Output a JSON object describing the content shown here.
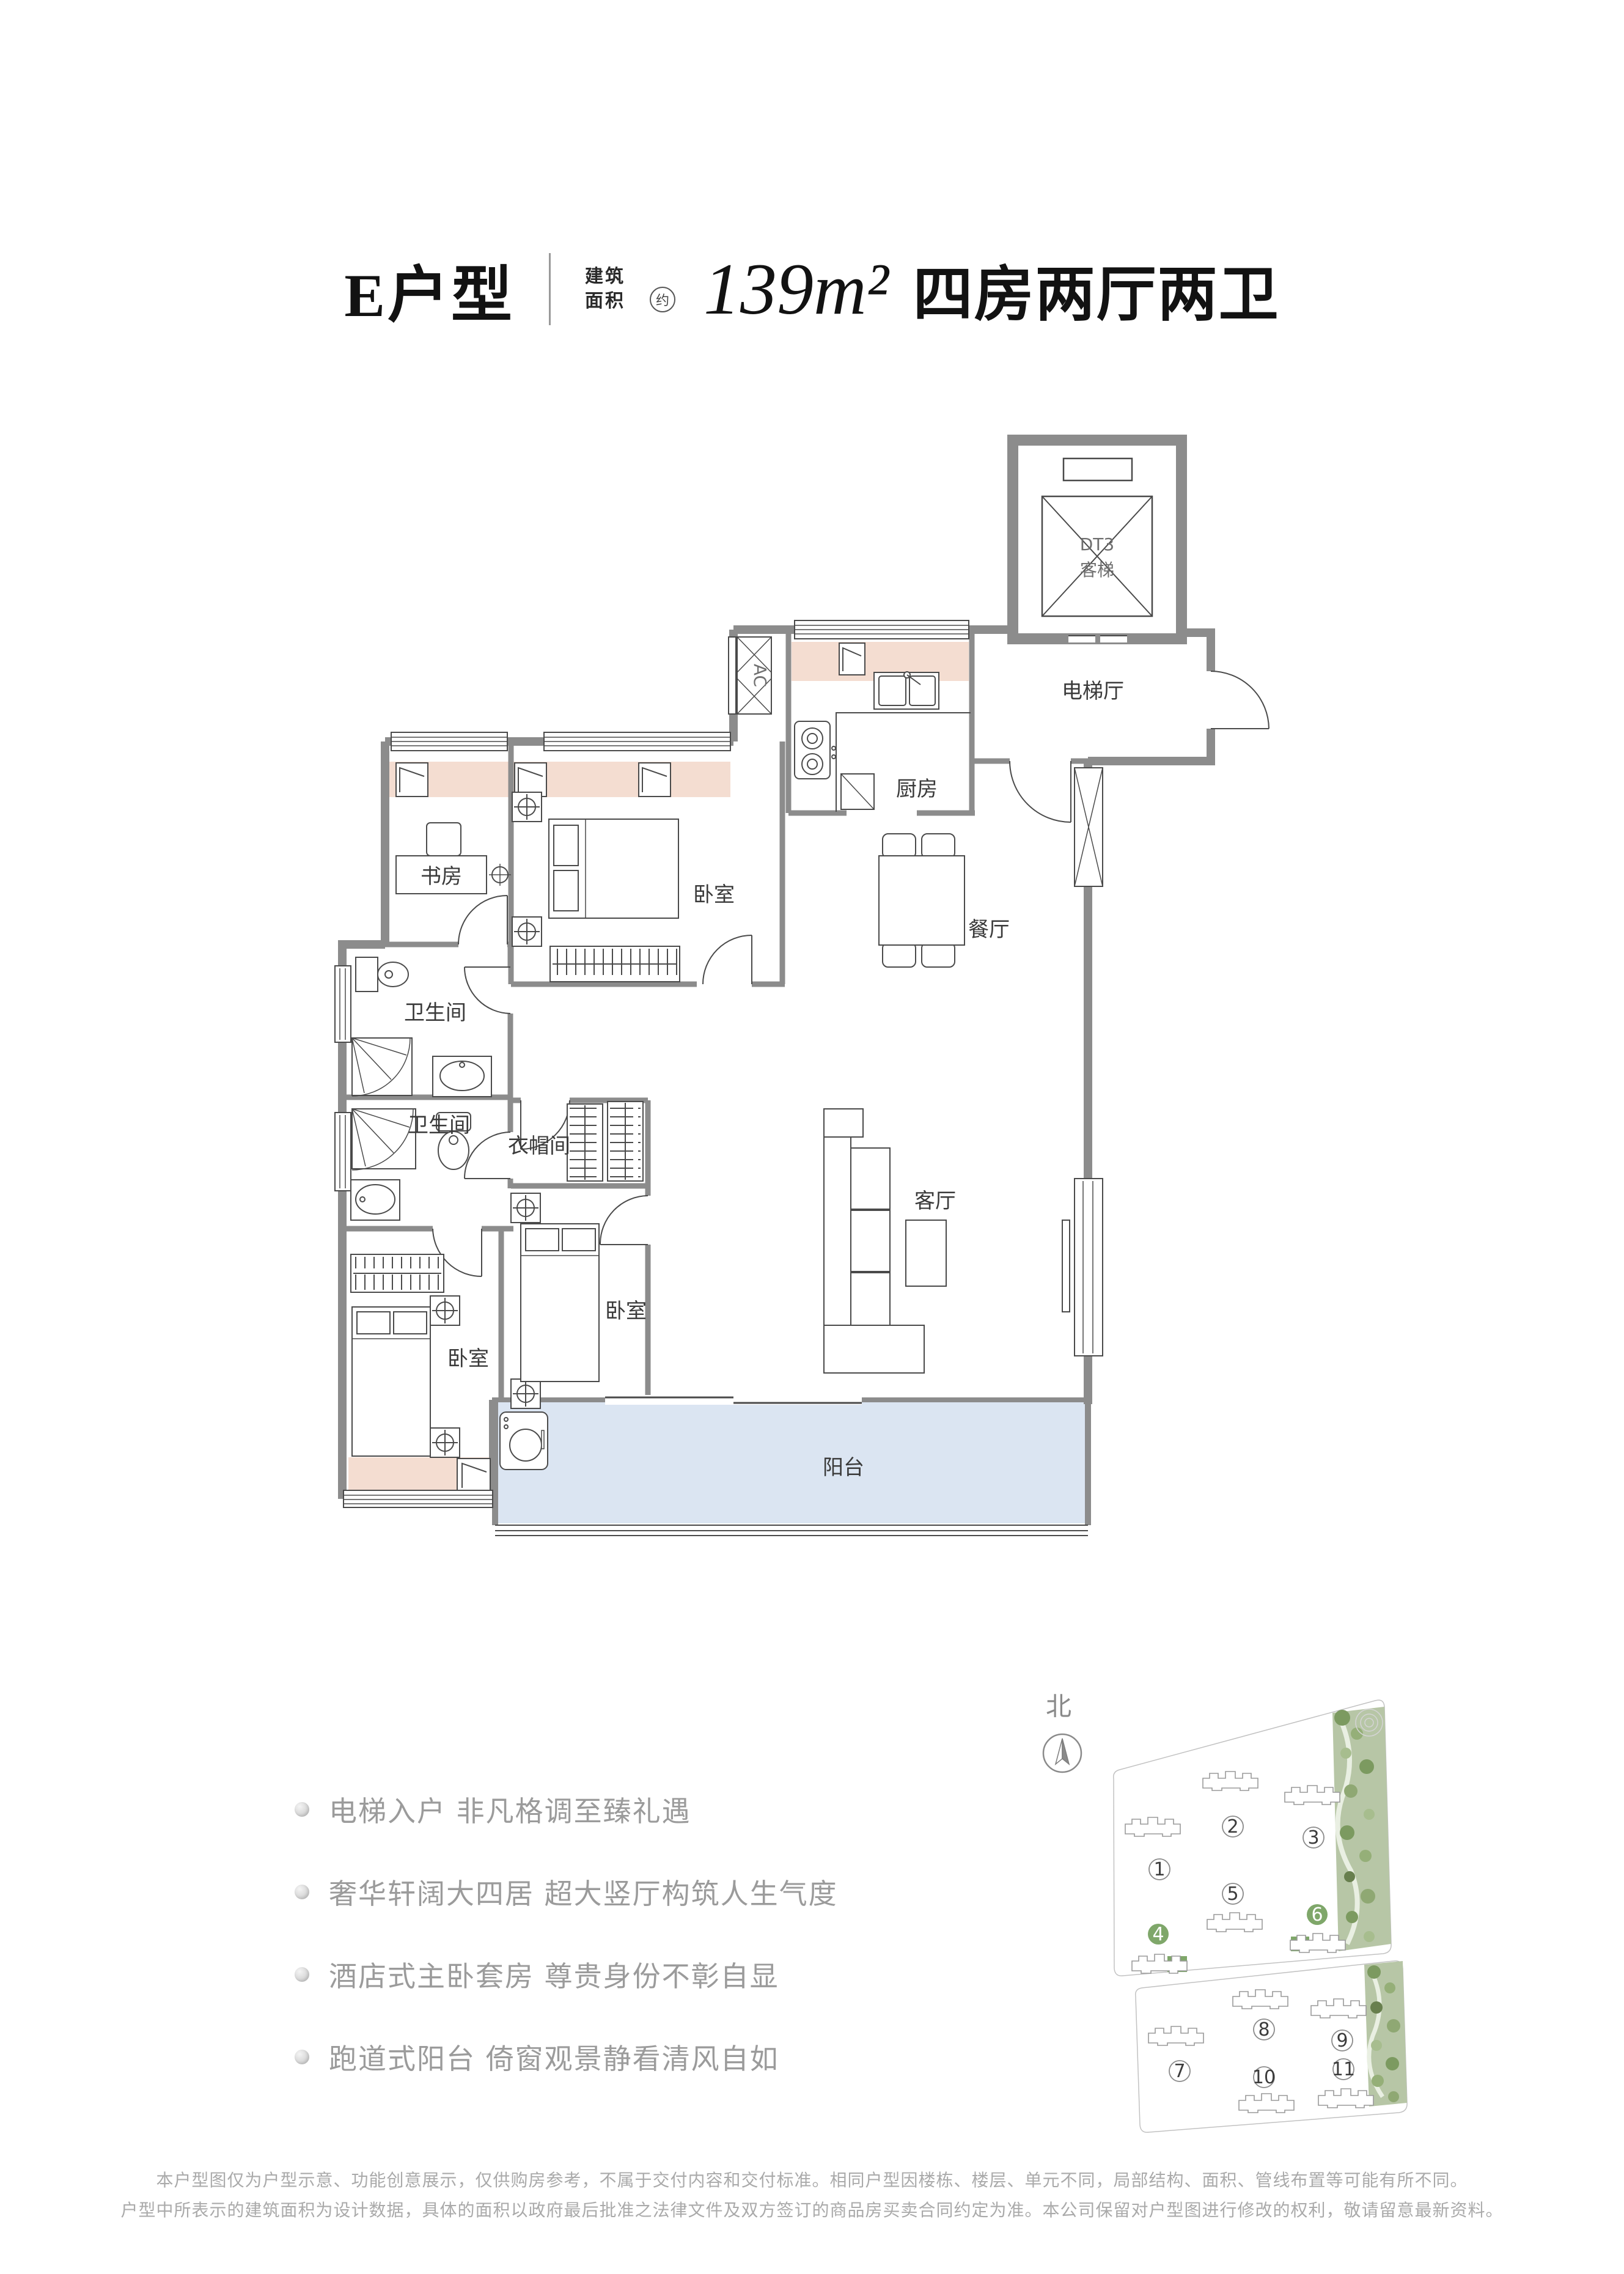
{
  "title": {
    "unit": "E户型",
    "area_label_line1": "建筑",
    "area_label_line2": "面积",
    "area_approx": "约",
    "area_value": "139m²",
    "layout_desc": "四房两厅两卫"
  },
  "floor_plan": {
    "wall_color": "#8c8c8c",
    "line_color": "#4a4a4a",
    "highlight_pink": "#f4ddd1",
    "balcony_blue": "#dbe5f2",
    "labels": {
      "elevator_line1": "DT3",
      "elevator_line2": "客梯",
      "elevator_hall": "电梯厅",
      "kitchen": "厨房",
      "dining": "餐厅",
      "study": "书房",
      "bedroom_top": "卧室",
      "bathroom_upper": "卫生间",
      "bathroom_lower": "卫生间",
      "cloakroom": "衣帽间",
      "living": "客厅",
      "bedroom_middle": "卧室",
      "bedroom_left": "卧室",
      "balcony": "阳台",
      "ac": "AC"
    }
  },
  "features": {
    "items": [
      "电梯入户 非凡格调至臻礼遇",
      "奢华轩阔大四居 超大竖厅构筑人生气度",
      "酒店式主卧套房 尊贵身份不彰自显",
      "跑道式阳台 倚窗观景静看清风自如"
    ]
  },
  "site_plan": {
    "north_label": "北",
    "building_numbers": [
      "1",
      "2",
      "3",
      "4",
      "5",
      "6",
      "7",
      "8",
      "9",
      "10",
      "11"
    ],
    "highlighted_buildings": [
      "4",
      "6"
    ],
    "highlight_color": "#7fa76a",
    "landscape_color": "#b7c6a6"
  },
  "disclaimer": {
    "line1": "本户型图仅为户型示意、功能创意展示，仅供购房参考，不属于交付内容和交付标准。相同户型因楼栋、楼层、单元不同，局部结构、面积、管线布置等可能有所不同。",
    "line2": "户型中所表示的建筑面积为设计数据，具体的面积以政府最后批准之法律文件及双方签订的商品房买卖合同约定为准。本公司保留对户型图进行修改的权利，敬请留意最新资料。"
  }
}
